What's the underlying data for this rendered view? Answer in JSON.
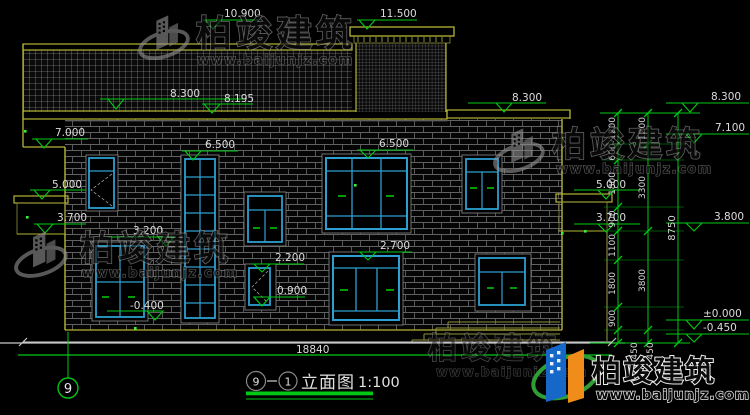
{
  "drawing": {
    "title": {
      "axis_start": "9",
      "axis_end": "1",
      "name": "立面图",
      "scale": "1:100"
    },
    "overall_width": "18840",
    "axis_bubble": "9",
    "elevations": {
      "parapet_top": "11.500",
      "ridge": "10.900",
      "roof_eave_left": "8.300",
      "roof_eave_mid": "8.195",
      "roof_eave_right": "8.300",
      "gable_bottom": "7.000",
      "left_balcony_top": "5.000",
      "left_balcony_floor": "3.700",
      "stair_window_top": "6.500",
      "main_window_top": "6.500",
      "left_window_top": "3.200",
      "left_ground": "-0.400",
      "small_window_top": "2.200",
      "small_window_sill": "0.900",
      "lower_window_top": "2.700",
      "right_roof": "8.300",
      "right_eave": "7.100",
      "right_balcony_top": "5.000",
      "right_balcony_floor": "3.700",
      "right_level": "3.800",
      "floor_zero": "±0.000",
      "ground_right": "-0.450"
    },
    "dim_chain_inner": [
      "1200",
      "600",
      "1800",
      "900",
      "1100",
      "1800",
      "900",
      "450"
    ],
    "dim_chain_mid": [
      "1200",
      "3300",
      "3800",
      "450"
    ],
    "dim_total": "8750"
  },
  "watermark": {
    "brand": "柏竣建筑",
    "url": "www.baijunjz.com"
  }
}
